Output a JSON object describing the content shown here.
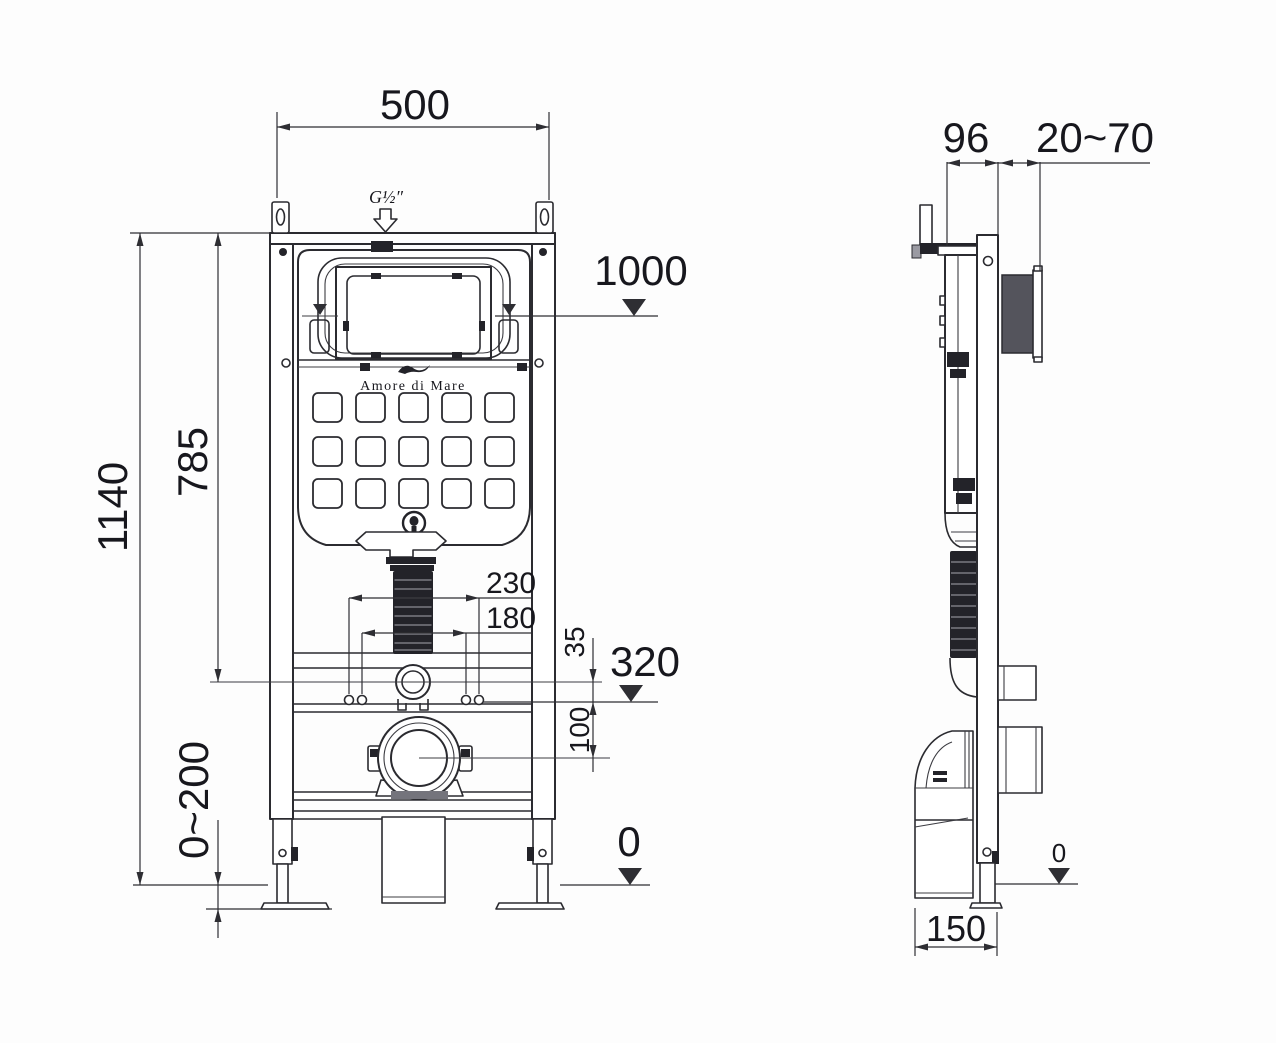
{
  "brand": "Amore di Mare",
  "front_view": {
    "width_top": "500",
    "thread_label": "G½″",
    "level_flush_plate": "1000",
    "height_total": "1140",
    "height_cistern": "785",
    "leg_adjust_range": "0~200",
    "fixing_outer": "230",
    "fixing_inner": "180",
    "inlet_offset": "35",
    "drain_offset": "100",
    "level_outlet": "320",
    "level_floor": "0"
  },
  "side_view": {
    "depth_cistern": "96",
    "plate_depth_range": "20~70",
    "base_depth": "150",
    "level_floor": "0"
  }
}
